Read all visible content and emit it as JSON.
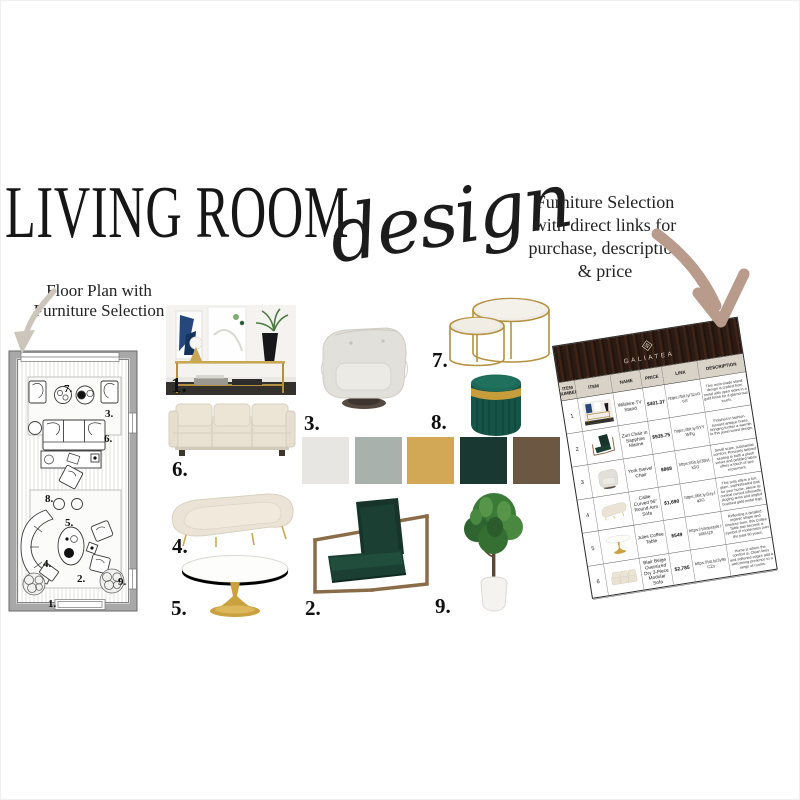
{
  "page": {
    "title": "LIVING ROOM",
    "title_script": "design"
  },
  "captions": {
    "floor_plan": {
      "line1": "Floor Plan with",
      "line2": "Furniture Selection"
    },
    "table": {
      "line1": "Furniture Selection",
      "line2": "with direct links for",
      "line3": "purchase, description",
      "line4": "& price"
    }
  },
  "board": {
    "labels": [
      "1.",
      "2.",
      "3.",
      "4.",
      "5.",
      "6.",
      "7.",
      "8.",
      "9."
    ]
  },
  "floor_plan": {
    "labels": [
      "1.",
      "2.",
      "3.",
      "4.",
      "5.",
      "6.",
      "7.",
      "8.",
      "9."
    ]
  },
  "palette": {
    "swatches": [
      "#e8e6e3",
      "#a9b1ad",
      "#d2a755",
      "#1a3832",
      "#6c5742"
    ]
  },
  "colors": {
    "arrow_right": "#b99b8c",
    "arrow_left": "#ccc5b9",
    "wood_header": "#301e16",
    "brand_text": "#d9cfc0",
    "table_header_bg": "#d9d2c7"
  },
  "table": {
    "brand": "GALIATEA",
    "columns": [
      "ITEM NUMBER",
      "ITEM",
      "NAME",
      "PRICE",
      "LINK",
      "DESCRIPTION"
    ],
    "rows": [
      {
        "num": "1",
        "name": "Wilshire TV Stand",
        "price": "$401.37",
        "link": "https://bit.ly/3zxGtVf",
        "desc": "This resin-made stand design is crafted from metal with open sides in a gold finish for a glamorous touch."
      },
      {
        "num": "2",
        "name": "Zuri Chair in Sapphire Marine",
        "price": "$935.75",
        "link": "https://bit.ly/3YYWFg",
        "desc": "Finished in fashion-forward antique brass, bringing further a warmth to this jewel toned design."
      },
      {
        "num": "3",
        "name": "York Swivel Chair",
        "price": "$868",
        "link": "https://bit.ly/3BvLk5G",
        "desc": "Small scale, substantial comfort. Precisely tailored seating in both a plush velvet and pebbled fabric offers a touch of spa movement."
      },
      {
        "num": "4",
        "name": "Callie Curved 96\" Round Arm Sofa",
        "price": "$1,690",
        "link": "https://bit.ly/3zyJq3G",
        "desc": "This sofa offers a fun, glam, sophisticated look for your home, above its conical curved silhouette, sloping arms and angled brushed gold metal legs."
      },
      {
        "num": "5",
        "name": "Jules Coffee Table",
        "price": "$549",
        "link": "https://shopstyle.it/l/bHZh",
        "desc": "Reflecting a detailed organic shape and timeless form, this Coffee Table has become a symbol of modernism over the past 60 years."
      },
      {
        "num": "6",
        "name": "Blair Beige Oversized Dry 3-Piece Modular Sofa",
        "price": "$2,785",
        "link": "https://bit.ly/3y9sCZs",
        "desc": "Home is where the comfort is. Clean lines and softened edges add a welcoming presence to a range of rooms."
      }
    ]
  }
}
